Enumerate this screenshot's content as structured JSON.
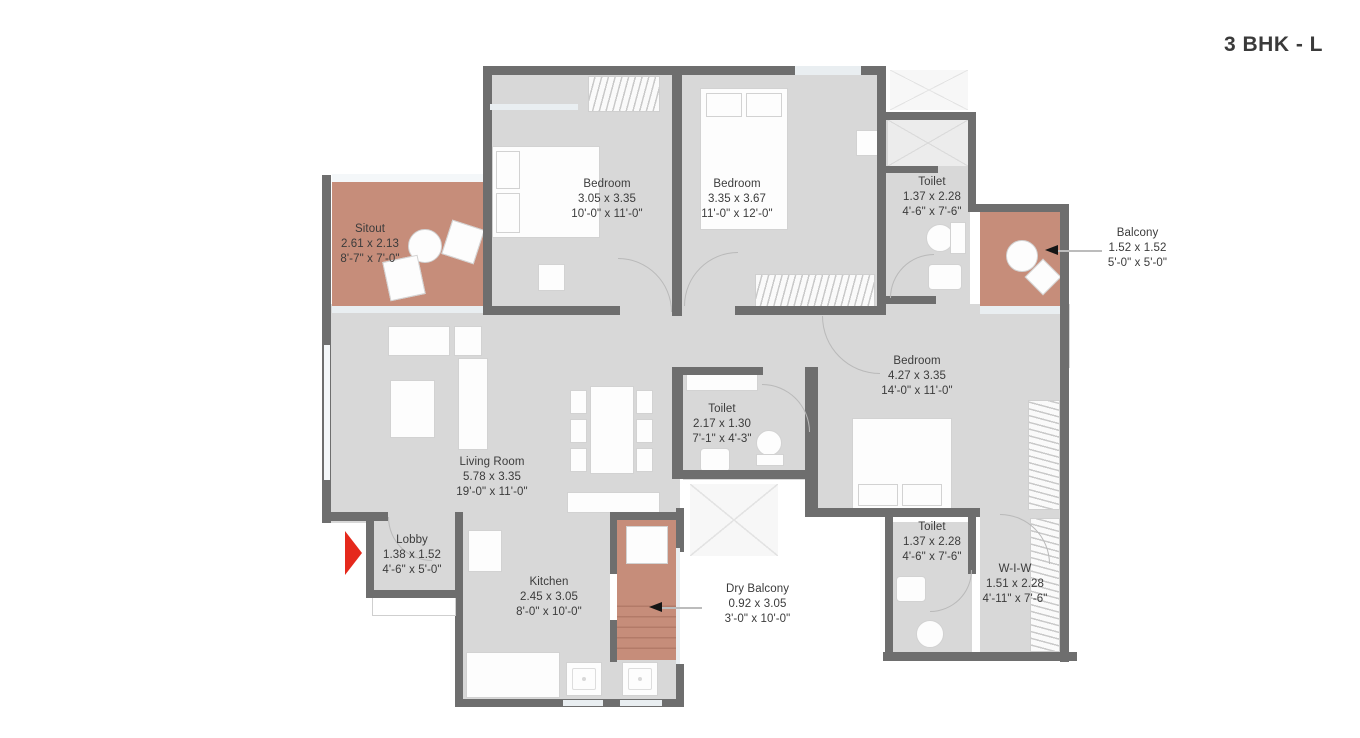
{
  "title": "3 BHK - L",
  "colors": {
    "wall": "#6e6e6e",
    "floor": "#d8d8d8",
    "accent": "#c68d7a",
    "entry_arrow": "#e5291c"
  },
  "rooms": [
    {
      "name": "Sitout",
      "metric": "2.61 x 2.13",
      "imperial": "8'-7\" x 7'-0\""
    },
    {
      "name": "Bedroom",
      "metric": "3.05 x 3.35",
      "imperial": "10'-0\" x 11'-0\""
    },
    {
      "name": "Bedroom",
      "metric": "3.35 x 3.67",
      "imperial": "11'-0\" x 12'-0\""
    },
    {
      "name": "Toilet",
      "metric": "1.37 x 2.28",
      "imperial": "4'-6\" x 7'-6\""
    },
    {
      "name": "Balcony",
      "metric": "1.52 x 1.52",
      "imperial": "5'-0\" x 5'-0\""
    },
    {
      "name": "Bedroom",
      "metric": "4.27 x 3.35",
      "imperial": "14'-0\" x 11'-0\""
    },
    {
      "name": "Toilet",
      "metric": "2.17 x 1.30",
      "imperial": "7'-1\" x 4'-3\""
    },
    {
      "name": "Living Room",
      "metric": "5.78 x 3.35",
      "imperial": "19'-0\" x 11'-0\""
    },
    {
      "name": "Lobby",
      "metric": "1.38 x 1.52",
      "imperial": "4'-6\" x 5'-0\""
    },
    {
      "name": "Kitchen",
      "metric": "2.45 x 3.05",
      "imperial": "8'-0\" x 10'-0\""
    },
    {
      "name": "Dry Balcony",
      "metric": "0.92 x 3.05",
      "imperial": "3'-0\" x 10'-0\""
    },
    {
      "name": "Toilet",
      "metric": "1.37 x 2.28",
      "imperial": "4'-6\" x 7'-6\""
    },
    {
      "name": "W-I-W",
      "metric": "1.51 x 2.28",
      "imperial": "4'-11\" x 7'-6\""
    }
  ]
}
